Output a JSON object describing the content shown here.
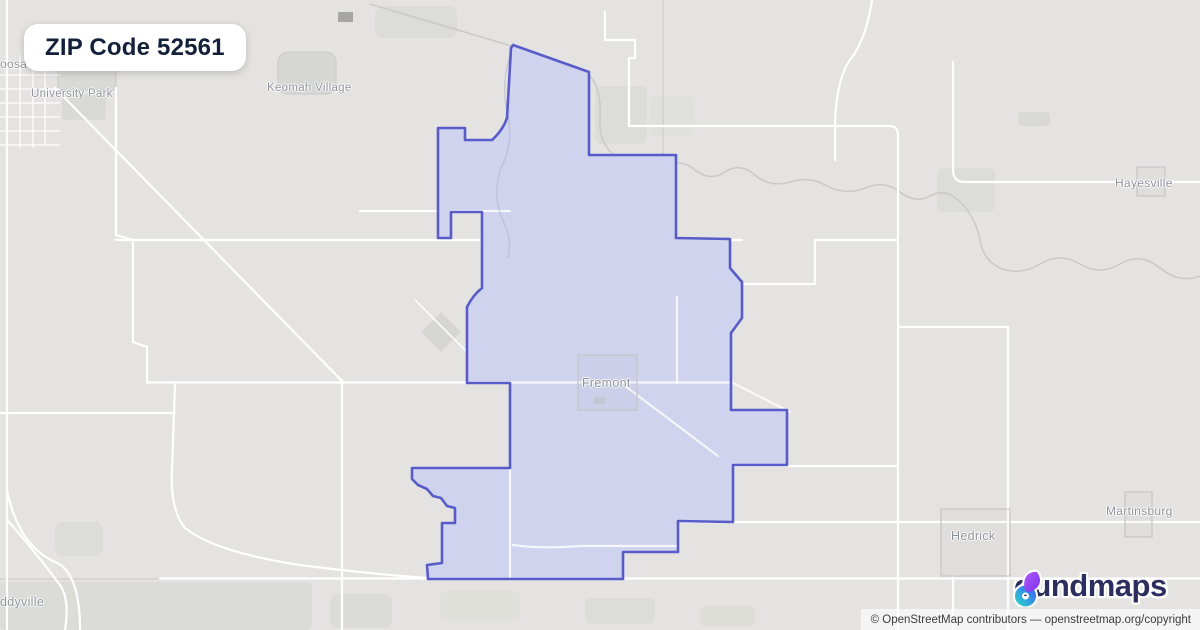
{
  "badge": {
    "title": "ZIP Code 52561"
  },
  "map": {
    "background": "#e4e3e1",
    "boundary_color": "#585cc9",
    "boundary_fill": "#cfd3ee",
    "road_color": "#ffffff",
    "zip_boundary_path": "M513,45 L589,72 L589,155 L676,155 L676,238 L730,239 L730,268 L742,282 L742,318 L731,333 L731,410 L787,410 L787,465 L733,465 L733,522 L678,521 L678,552 L623,552 L623,579 L428,579 L427,565 L442,563 L442,523 L455,523 L455,508 L447,506 L441,498 L433,496 L427,489 L418,485 L412,479 L412,468 L510,468 L510,383 L467,383 L467,307 Q473,295 482,288 L482,212 L451,212 L451,238 L438,238 L438,128 L465,128 L465,140 L492,140 Q503,130 507,118 L511,48 Z",
    "places": [
      {
        "label": "oosa",
        "x": 0,
        "y": 57,
        "size": 12
      },
      {
        "label": "University Park",
        "x": 31,
        "y": 88,
        "size": 11.5
      },
      {
        "label": "Keomah Village",
        "x": 267,
        "y": 82,
        "size": 11.5
      },
      {
        "label": "Hayesville",
        "x": 1115,
        "y": 176,
        "size": 12
      },
      {
        "label": "Fremont",
        "x": 582,
        "y": 376,
        "size": 12.5
      },
      {
        "label": "Hedrick",
        "x": 951,
        "y": 529,
        "size": 12.5
      },
      {
        "label": "Martinsburg",
        "x": 1106,
        "y": 504,
        "size": 12
      },
      {
        "label": "ddyville",
        "x": 0,
        "y": 595,
        "size": 12.5
      }
    ],
    "city_squares": [
      {
        "name": "fremont-boundary",
        "x": 578,
        "y": 355,
        "w": 59,
        "h": 55
      },
      {
        "name": "hayesville-boundary",
        "x": 1137,
        "y": 167,
        "w": 28,
        "h": 29
      },
      {
        "name": "hedrick-boundary",
        "x": 941,
        "y": 509,
        "w": 69,
        "h": 67
      },
      {
        "name": "martinsburg-boundary",
        "x": 1125,
        "y": 492,
        "w": 27,
        "h": 45
      }
    ]
  },
  "logo": {
    "text": "oundmaps",
    "full_name": "boundmaps",
    "glyph_purple": "#8b3dff",
    "glyph_teal": "#2cc8cf",
    "glyph_blue": "#3a6cf3",
    "text_color": "#2b2e5f"
  },
  "attribution": {
    "prefix": "© OpenStreetMap contributors — ",
    "link": "openstreetmap.org/copyright"
  }
}
